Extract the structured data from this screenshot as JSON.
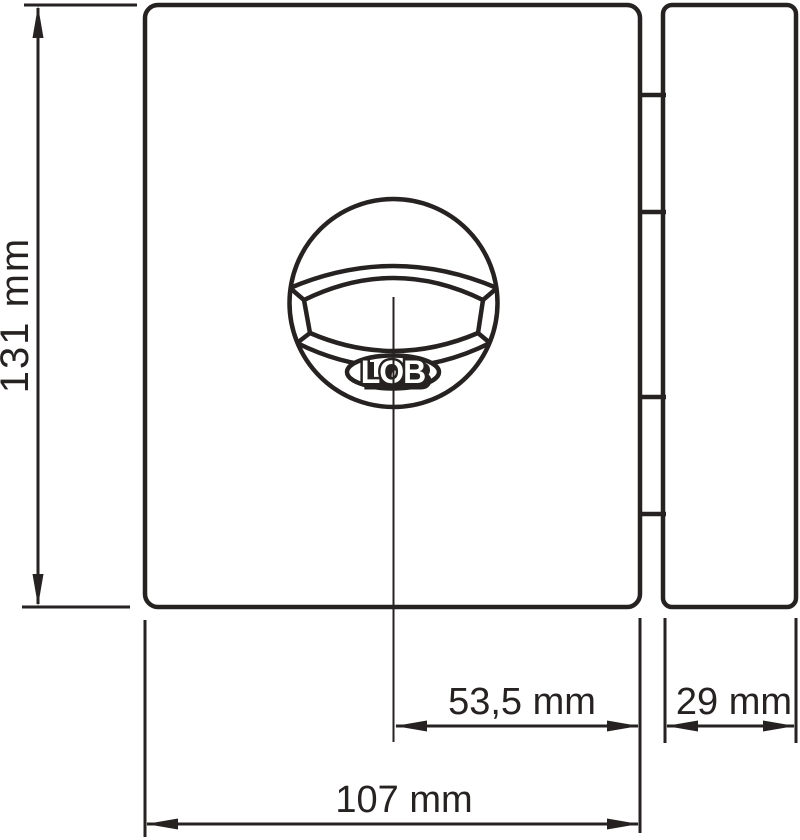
{
  "drawing": {
    "type": "technical-dimension-drawing",
    "subject": "surface-mounted rim lock: lock body with round knob (front view) and strike plate",
    "logo_text": "LOB",
    "colors": {
      "line": "#262221",
      "background": "#ffffff"
    },
    "labels": {
      "body_height": "131 mm",
      "knob_center_to_edge": "53,5 mm",
      "strike_plate_width": "29 mm",
      "body_width": "107 mm"
    }
  }
}
